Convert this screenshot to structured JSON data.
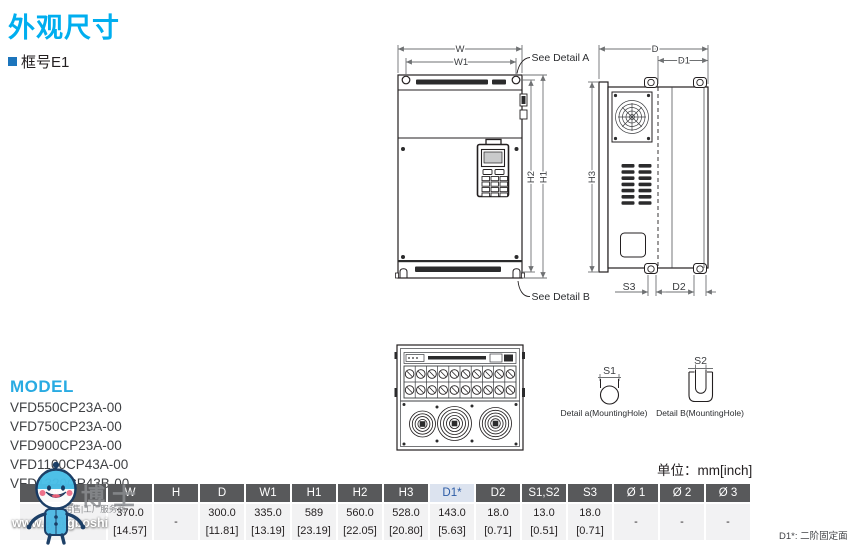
{
  "header": {
    "title": "外观尺寸",
    "frame_label": "框号E1"
  },
  "model": {
    "heading": "MODEL",
    "items": [
      "VFD550CP23A-00",
      "VFD750CP23A-00",
      "VFD900CP23A-00",
      "VFD1100CP43A-00",
      "VFD1320CP43B-00"
    ]
  },
  "drawing": {
    "front": {
      "w": "W",
      "w1": "W1",
      "h1": "H1",
      "h2": "H2",
      "see_a": "See Detail A",
      "see_b": "See Detail B"
    },
    "side": {
      "d": "D",
      "d1": "D1",
      "h3": "H3",
      "s3": "S3",
      "d2": "D2"
    },
    "details": {
      "s1": "S1",
      "s2": "S2",
      "label_a": "Detail a(MountingHole)",
      "label_b": "Detail B(MountingHole)"
    }
  },
  "table": {
    "unit_note": "单位：mm[inch]",
    "headers": [
      "框号",
      "W",
      "H",
      "D",
      "W1",
      "H1",
      "H2",
      "H3",
      "D1*",
      "D2",
      "S1,S2",
      "S3",
      "Ø 1",
      "Ø 2",
      "Ø 3"
    ],
    "frame": "E1",
    "mm": [
      "370.0",
      "-",
      "300.0",
      "335.0",
      "589",
      "560.0",
      "528.0",
      "143.0",
      "18.0",
      "13.0",
      "18.0",
      "-",
      "-",
      "-"
    ],
    "inch": [
      "[14.57]",
      "",
      "[11.81]",
      "[13.19]",
      "[23.19]",
      "[22.05]",
      "[20.80]",
      "[5.63]",
      "[0.71]",
      "[0.51]",
      "[0.71]",
      "",
      "",
      ""
    ],
    "footnote": "D1*: 二阶固定面"
  },
  "watermark": {
    "brand": "工博士",
    "tagline": "销售|工厂服务商",
    "url": "www.gongboshi"
  },
  "colors": {
    "accent": "#00AEEF",
    "bullet": "#1C75BC",
    "header_bg": "#58595B",
    "highlight_bg": "#DCE3EF",
    "highlight_text": "#2D5CA6",
    "row_bg": "#F2F2F3"
  }
}
